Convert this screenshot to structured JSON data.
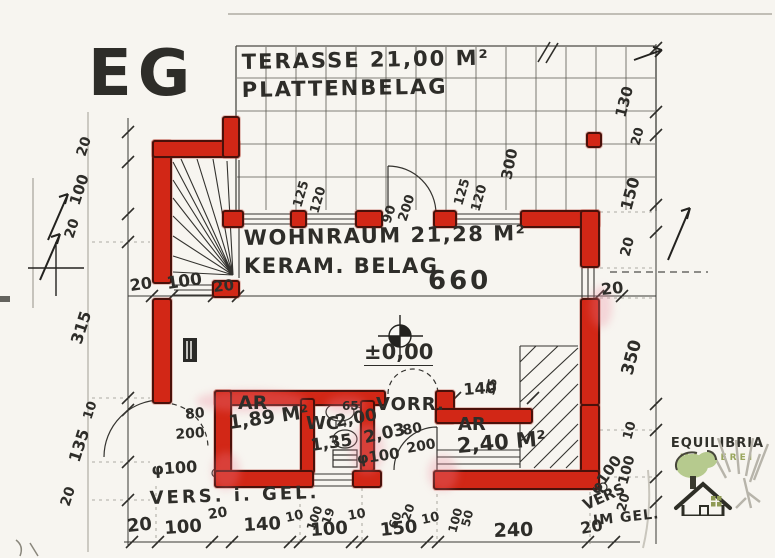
{
  "plan": {
    "floor_label": "EG",
    "terrace": {
      "area_label": "TERASSE 21,00 M²",
      "finish_label": "PLATTENBELAG",
      "side_dim": "300"
    },
    "living": {
      "area_label": "WOHNRAUM 21,28 M²",
      "finish_label": "KERAM. BELAG",
      "width_dim": "660",
      "level": "±0,00"
    },
    "rooms": [
      {
        "name": "AR",
        "area": "1,89 M²"
      },
      {
        "name": "WC",
        "width": "2,00",
        "depth": "1,35",
        "niche": "65"
      },
      {
        "name": "VORR.",
        "size": "2,03"
      },
      {
        "name": "AR",
        "area": "2,40 M²"
      }
    ],
    "doors": {
      "terrace_door": [
        "90",
        "200"
      ],
      "left_door": [
        "80",
        "200"
      ],
      "bottom_door": [
        "80",
        "200"
      ]
    },
    "window_dims": [
      "125",
      "120",
      "125",
      "120"
    ],
    "dims": {
      "left": [
        "20",
        "100",
        "20",
        "315",
        "10",
        "135",
        "20"
      ],
      "right": [
        "130",
        "20",
        "150",
        "20",
        "350",
        "10",
        "100",
        "20"
      ],
      "mid": [
        "20",
        "100",
        "20",
        "660",
        "20"
      ],
      "bottom": [
        "20",
        "100",
        "20",
        "140",
        "10",
        "100",
        "10",
        "150",
        "10",
        "240",
        "20"
      ],
      "opening": "140",
      "stair_width": "35",
      "annotations": [
        "100",
        "19",
        "60",
        "20",
        "100",
        "50"
      ]
    },
    "notes": {
      "drain": "φ100",
      "vers_left": "VERS. i. GEL.",
      "vers_right_line1": "VERS",
      "vers_right_line2": "IM GEL."
    }
  },
  "logo": {
    "name": "EQUILIBRIA",
    "tagline": "MAKLEREI"
  },
  "colors": {
    "wall_red": "#d22716",
    "ink": "#2e2d29",
    "logo_green": "#b6ca8e",
    "logo_olive": "#9aa65e"
  }
}
